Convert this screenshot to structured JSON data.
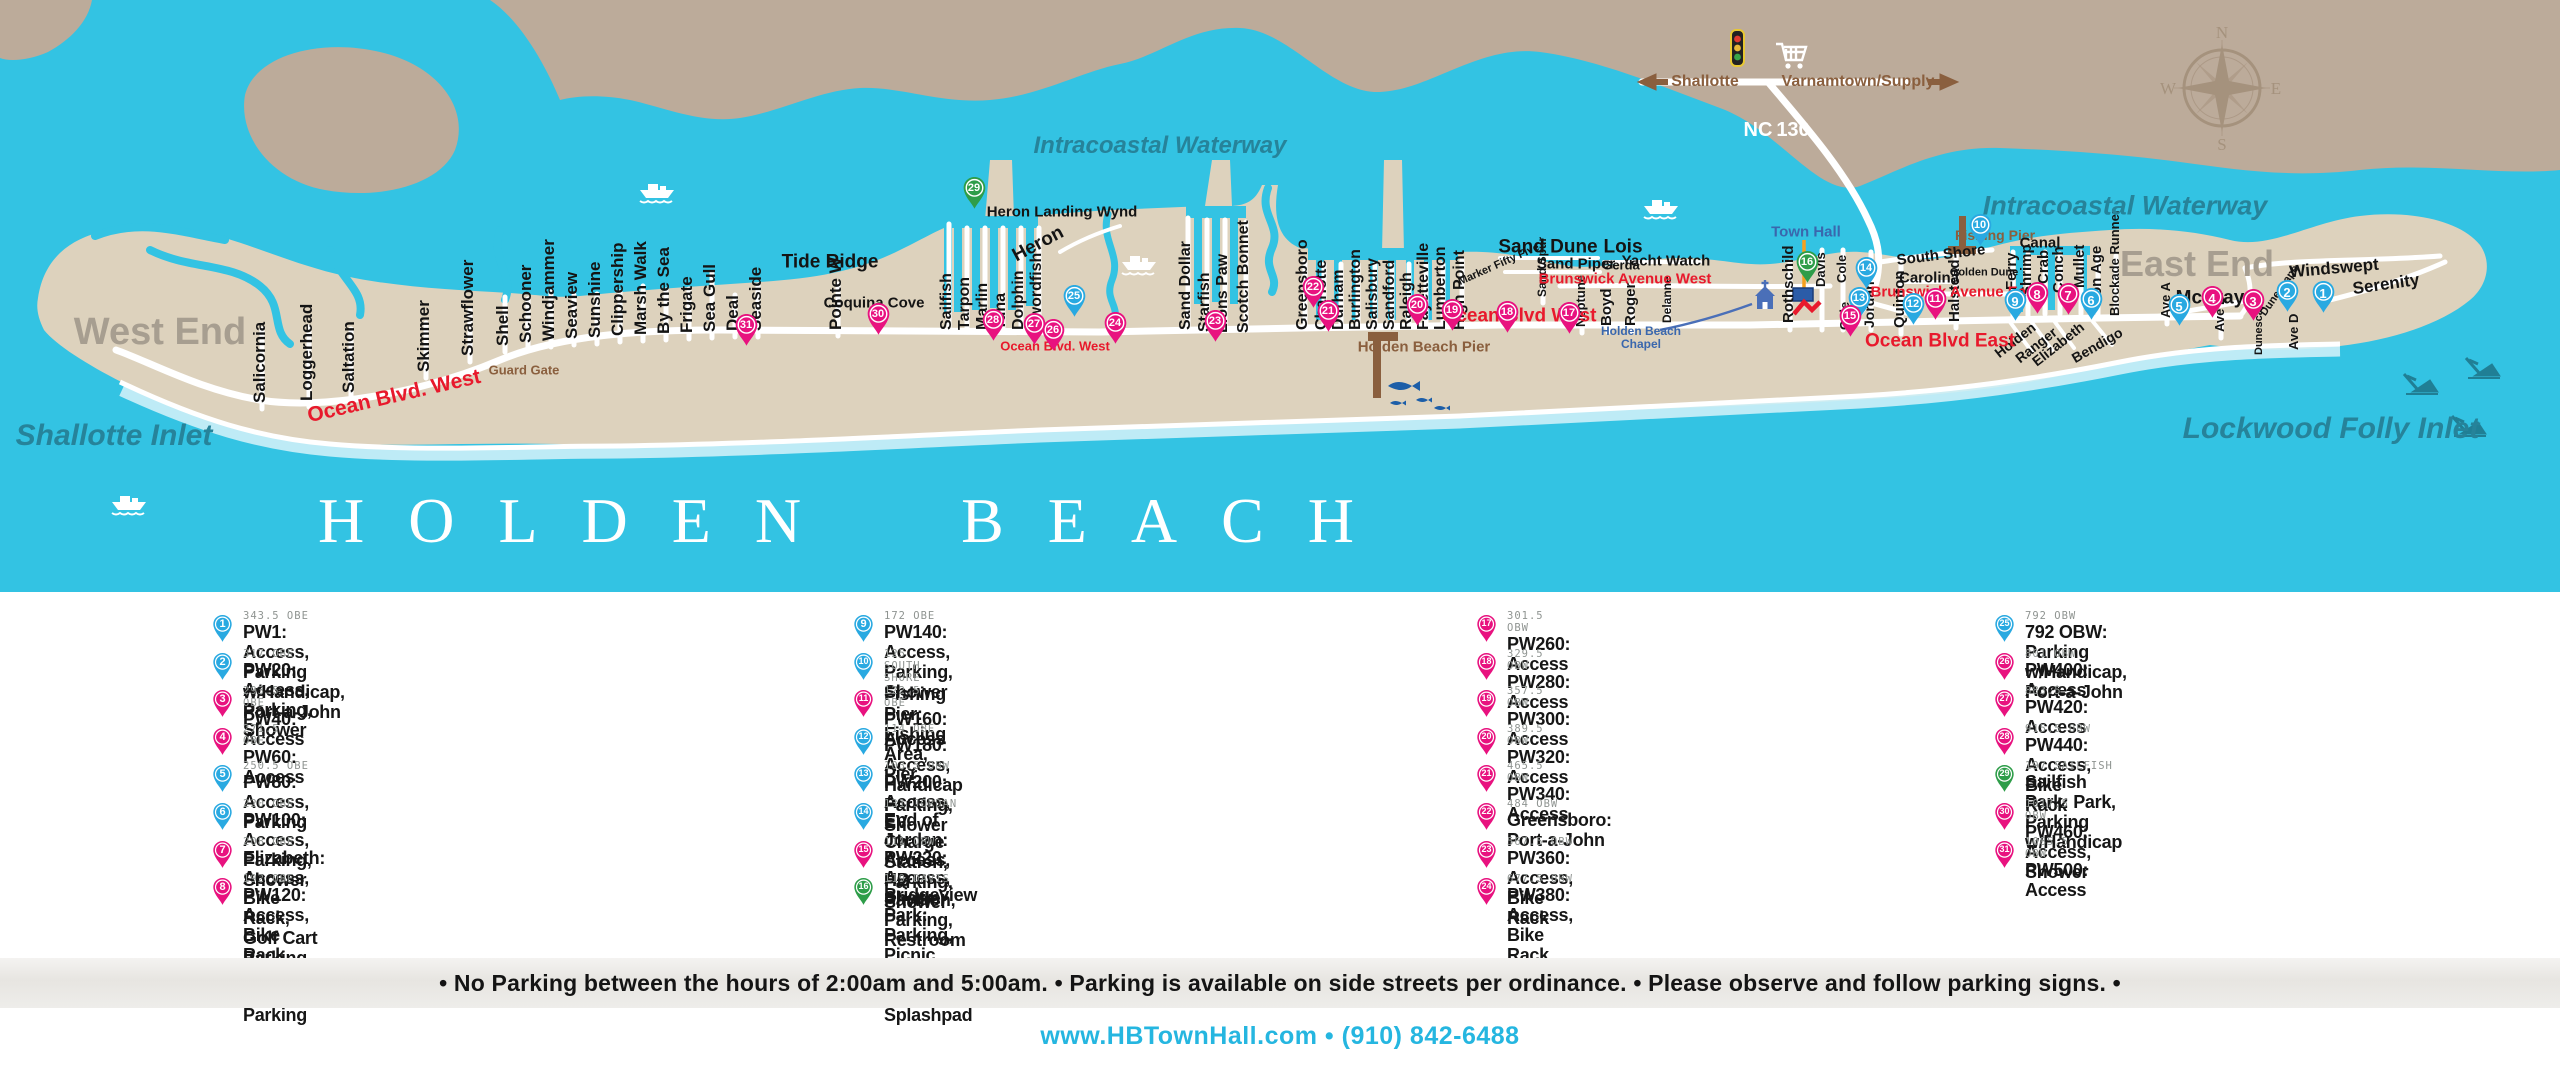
{
  "map": {
    "title_words": [
      "HOLDEN",
      "BEACH"
    ],
    "colors": {
      "water": "#33c3e3",
      "mainland": "#bcab9a",
      "island": "#ddd2bd",
      "pin_pink": "#e8127f",
      "pin_blue": "#29a9e1",
      "pin_green": "#2e9d49",
      "road": "#ffffff",
      "pier_brown": "#8a5f3e",
      "accent_red": "#e8192c",
      "link_cyan": "#25b6e0",
      "orange_pointer": "#f5a01e"
    },
    "compass": {
      "n": "N",
      "e": "E",
      "s": "S",
      "w": "W"
    },
    "vstreets": [
      [
        "Salicornia",
        262,
        403,
        17,
        80
      ],
      [
        "Loggerhead",
        309,
        401,
        17,
        80
      ],
      [
        "Saltation",
        351,
        393,
        17,
        70
      ],
      [
        "Skimmer",
        426,
        372,
        17,
        55
      ],
      [
        "Strawflower",
        470,
        356,
        17,
        52
      ],
      [
        "Shell",
        505,
        346,
        17,
        55
      ],
      [
        "Schooner",
        528,
        343,
        17,
        50
      ],
      [
        "Windjammer",
        551,
        341,
        17,
        55
      ],
      [
        "Seaview",
        574,
        339,
        17,
        50
      ],
      [
        "Sunshine",
        597,
        338,
        17,
        50
      ],
      [
        "Clippership",
        620,
        336,
        17,
        50
      ],
      [
        "Marsh Walk",
        643,
        335,
        17,
        55
      ],
      [
        "By the Sea",
        666,
        334,
        17,
        50
      ],
      [
        "Frigate",
        689,
        333,
        17,
        50
      ],
      [
        "Sea Gull",
        712,
        332,
        17,
        65
      ],
      [
        "Deal",
        735,
        331,
        17,
        42
      ],
      [
        "Seaside",
        758,
        331,
        17,
        52
      ],
      [
        "Pointe W",
        838,
        330,
        17,
        52
      ],
      [
        "Sailfish",
        949,
        330,
        16,
        0
      ],
      [
        "Tarpon",
        967,
        330,
        16,
        0
      ],
      [
        "Marlin",
        985,
        330,
        16,
        0
      ],
      [
        "Tuna",
        1003,
        330,
        16,
        0
      ],
      [
        "Dolphin",
        1021,
        330,
        16,
        0
      ],
      [
        "Swordfish",
        1039,
        330,
        16,
        0
      ],
      [
        "Sand Dollar",
        1188,
        330,
        16,
        0
      ],
      [
        "Starfish",
        1207,
        332,
        16,
        0
      ],
      [
        "Lions Paw",
        1225,
        333,
        16,
        0
      ],
      [
        "Scotch Bonnet",
        1246,
        333,
        16,
        0
      ],
      [
        "Greensboro",
        1305,
        330,
        16,
        0
      ],
      [
        "Charlotte",
        1324,
        330,
        16,
        0
      ],
      [
        "Durham",
        1341,
        330,
        16,
        0
      ],
      [
        "Burlington",
        1358,
        330,
        16,
        0
      ],
      [
        "Salisbury",
        1375,
        330,
        16,
        0
      ],
      [
        "Sandford",
        1392,
        330,
        16,
        0
      ],
      [
        "Raleigh",
        1409,
        330,
        16,
        0
      ],
      [
        "Fayetteville",
        1426,
        330,
        16,
        0
      ],
      [
        "Lumberton",
        1443,
        330,
        16,
        0
      ],
      [
        "High Point",
        1462,
        330,
        16,
        0
      ],
      [
        "Sand Spur",
        1543,
        297,
        12,
        40
      ],
      [
        "Neptune",
        1582,
        327,
        13,
        38
      ],
      [
        "Boyd",
        1608,
        326,
        15,
        38
      ],
      [
        "Roger",
        1632,
        326,
        15,
        38
      ],
      [
        "Delanne",
        1668,
        323,
        12,
        32
      ],
      [
        "Rothschild",
        1790,
        323,
        15,
        60
      ],
      [
        "Davis",
        1822,
        287,
        13,
        0
      ],
      [
        "Cole",
        1843,
        283,
        13,
        0
      ],
      [
        "Cole",
        1846,
        330,
        13,
        0
      ],
      [
        "Jordan",
        1871,
        328,
        14,
        0
      ],
      [
        "Quinton",
        1901,
        328,
        15,
        70
      ],
      [
        "Halstead",
        1956,
        322,
        15,
        78
      ],
      [
        "Ferry",
        2013,
        290,
        15,
        0
      ],
      [
        "Shrimp",
        2028,
        296,
        15,
        0
      ],
      [
        "Crab",
        2045,
        284,
        15,
        0
      ],
      [
        "Conch",
        2060,
        293,
        15,
        0
      ],
      [
        "Mullet",
        2081,
        288,
        15,
        0
      ],
      [
        "Iron Age",
        2098,
        306,
        15,
        0
      ],
      [
        "Blockade Runner",
        2116,
        316,
        13,
        0
      ],
      [
        "Ave A",
        2167,
        318,
        13,
        20
      ],
      [
        "Ave B",
        2221,
        332,
        13,
        18
      ],
      [
        "Dunescape",
        2261,
        355,
        11,
        0
      ],
      [
        "Ave D",
        2295,
        350,
        13,
        0
      ]
    ],
    "labels": [
      [
        "Intracoastal Waterway",
        1160,
        146,
        24,
        "teal",
        0
      ],
      [
        "Intracoastal Waterway",
        2125,
        206,
        27,
        "teal",
        0
      ],
      [
        "West End",
        160,
        332,
        38,
        "gray",
        0
      ],
      [
        "East End",
        2197,
        264,
        36,
        "gray",
        0
      ],
      [
        "Shallotte Inlet",
        114,
        436,
        30,
        "teal",
        0
      ],
      [
        "Lockwood Folly Inlet",
        2331,
        429,
        30,
        "teal",
        0
      ],
      [
        "Shallotte",
        1705,
        82,
        16,
        "brown",
        0
      ],
      [
        "Varnamtown/Supply",
        1858,
        82,
        16,
        "brown",
        0
      ],
      [
        "NC",
        1758,
        130,
        20,
        "white",
        0
      ],
      [
        "130",
        1793,
        130,
        20,
        "white",
        0
      ],
      [
        "Town Hall",
        1806,
        232,
        15,
        "blue",
        0
      ],
      [
        "Holden Beach",
        1641,
        331,
        12,
        "blue",
        0
      ],
      [
        "Chapel",
        1641,
        344,
        12,
        "blue",
        0
      ],
      [
        "Guard Gate",
        524,
        370,
        13,
        "brown",
        0
      ],
      [
        "Holden Beach Pier",
        1424,
        347,
        15,
        "brown",
        0
      ],
      [
        "Fishing Pier",
        1995,
        235,
        14,
        "brown",
        0
      ],
      [
        "Tide Ridge",
        830,
        262,
        19,
        "black",
        0
      ],
      [
        "Coquina Cove",
        874,
        303,
        15,
        "black",
        0
      ],
      [
        "Heron Landing Wynd",
        1062,
        212,
        15,
        "black",
        0
      ],
      [
        "Heron",
        1038,
        244,
        19,
        "black",
        -28
      ],
      [
        "Sand Dune",
        1548,
        247,
        19,
        "black",
        0
      ],
      [
        "Sand Piper",
        1576,
        264,
        15,
        "black",
        0
      ],
      [
        "Lois",
        1623,
        247,
        19,
        "black",
        0
      ],
      [
        "Gerda",
        1621,
        265,
        13,
        "black",
        0
      ],
      [
        "Yacht Watch",
        1666,
        261,
        15,
        "black",
        0
      ],
      [
        "Marker Fifty Five",
        1499,
        265,
        11,
        "black",
        -24
      ],
      [
        "South Shore",
        1941,
        255,
        15,
        "black",
        -7
      ],
      [
        "Carolina",
        1929,
        278,
        15,
        "black",
        0
      ],
      [
        "Golden Dune",
        1984,
        273,
        11,
        "black",
        0
      ],
      [
        "Canal",
        2040,
        243,
        15,
        "black",
        0
      ],
      [
        "McCray",
        2210,
        298,
        19,
        "black",
        0
      ],
      [
        "Windswept",
        2334,
        268,
        17,
        "black",
        -5
      ],
      [
        "Serenity",
        2386,
        284,
        17,
        "black",
        -8
      ],
      [
        "Holden",
        2015,
        340,
        14,
        "black",
        -38
      ],
      [
        "Ranger",
        2036,
        345,
        14,
        "black",
        -38
      ],
      [
        "Elizabeth",
        2058,
        344,
        14,
        "black",
        -38
      ],
      [
        "Bendigo",
        2097,
        345,
        14,
        "black",
        -30
      ],
      [
        "Dunescape",
        2280,
        291,
        11,
        "black",
        -55
      ],
      [
        "Ocean Blvd. West",
        394,
        396,
        21,
        "red",
        -13
      ],
      [
        "Ocean Blvd. West",
        1055,
        346,
        13,
        "red",
        0
      ],
      [
        "Ocean Blvd West",
        1519,
        316,
        19,
        "red",
        0
      ],
      [
        "Ocean Blvd East",
        1940,
        341,
        19,
        "red",
        0
      ],
      [
        "Brunswick Avenue West",
        1625,
        279,
        15,
        "red",
        0
      ],
      [
        "Brunswick   Avenue East",
        1955,
        292,
        15,
        "red",
        0
      ]
    ],
    "markers": [
      [
        1,
        2323,
        314,
        "blue"
      ],
      [
        2,
        2287,
        313,
        "blue"
      ],
      [
        3,
        2253,
        322,
        "pink"
      ],
      [
        4,
        2212,
        319,
        "pink"
      ],
      [
        5,
        2179,
        327,
        "blue"
      ],
      [
        6,
        2091,
        321,
        "blue"
      ],
      [
        7,
        2068,
        316,
        "pink"
      ],
      [
        8,
        2037,
        315,
        "pink"
      ],
      [
        9,
        2015,
        322,
        "blue"
      ],
      [
        10,
        1980,
        247,
        "blue"
      ],
      [
        11,
        1935,
        321,
        "pink"
      ],
      [
        12,
        1913,
        326,
        "blue"
      ],
      [
        13,
        1859,
        320,
        "blue"
      ],
      [
        14,
        1866,
        290,
        "blue"
      ],
      [
        15,
        1850,
        338,
        "pink"
      ],
      [
        16,
        1807,
        284,
        "green"
      ],
      [
        17,
        1569,
        335,
        "pink"
      ],
      [
        18,
        1507,
        334,
        "pink"
      ],
      [
        19,
        1452,
        332,
        "pink"
      ],
      [
        20,
        1417,
        327,
        "pink"
      ],
      [
        21,
        1328,
        333,
        "pink"
      ],
      [
        22,
        1313,
        309,
        "pink"
      ],
      [
        23,
        1215,
        343,
        "pink"
      ],
      [
        24,
        1115,
        345,
        "pink"
      ],
      [
        25,
        1074,
        318,
        "blue"
      ],
      [
        26,
        1053,
        352,
        "pink"
      ],
      [
        27,
        1034,
        346,
        "pink"
      ],
      [
        28,
        993,
        342,
        "pink"
      ],
      [
        29,
        974,
        210,
        "green"
      ],
      [
        30,
        878,
        336,
        "pink"
      ],
      [
        31,
        746,
        347,
        "pink"
      ]
    ],
    "direction_signs": {
      "west": "Shallotte",
      "east": "Varnamtown/Supply"
    }
  },
  "legend": {
    "columns": [
      [
        {
          "n": 1,
          "c": "blue",
          "addr": "343.5 OBE",
          "name": "PW1: Access, Parking w/Handicap, Port-a-John"
        },
        {
          "n": 2,
          "c": "blue",
          "addr": "317 OBE",
          "name": "PW20: Access, Parking, Shower"
        },
        {
          "n": 3,
          "c": "pink",
          "addr": "293.5 OBE",
          "name": "PW40: Access"
        },
        {
          "n": 4,
          "c": "pink",
          "addr": "271.5 OBE",
          "name": "PW60: Access"
        },
        {
          "n": 5,
          "c": "blue",
          "addr": "250.5 OBE",
          "name": "PW80: Access, Parking"
        },
        {
          "n": 6,
          "c": "blue",
          "addr": "220 OBE",
          "name": "PW100: Access, Parking, Shower"
        },
        {
          "n": 7,
          "c": "pink",
          "addr": "208 OBE",
          "name": "Elizabeth: Access, Bike Rack, Golf Cart Parking"
        },
        {
          "n": 8,
          "c": "pink",
          "addr": "192 OBE",
          "name": "PW120: Access, Bike Rack, Golf Cart Parking"
        }
      ],
      [
        {
          "n": 9,
          "c": "blue",
          "addr": "172 OBE",
          "name": "PW140: Access, Parking, Shower"
        },
        {
          "n": 10,
          "c": "blue",
          "addr": "125 SOUTH SHORE",
          "name": "Fishing Pier: Fishing Area, Pier"
        },
        {
          "n": 11,
          "c": "pink",
          "addr": "122.5 OBE",
          "name": "PW160: Access"
        },
        {
          "n": 12,
          "c": "blue",
          "addr": "114 OBE",
          "name": "PW180: Access, Handicap Parking, Shower"
        },
        {
          "n": 13,
          "c": "blue",
          "addr": "103.5 OBW",
          "name": "PW200: Access, EV Charge Station, Parking, Shower"
        },
        {
          "n": 14,
          "c": "blue",
          "addr": "131 JORDAN",
          "name": "End of Jordan: Access, HB Pavilion, Parking, Restroom"
        },
        {
          "n": 15,
          "c": "pink",
          "addr": "111 OBW",
          "name": "PW220: Access, Shower"
        },
        {
          "n": 16,
          "c": "green",
          "addr": "119 DAVIS",
          "name": "Bridgeview Park: Parking, Picnic Shelter, Playground, Splashpad"
        }
      ],
      [
        {
          "n": 17,
          "c": "pink",
          "addr": "301.5 OBW",
          "name": "PW260: Access"
        },
        {
          "n": 18,
          "c": "pink",
          "addr": "329.5 OBW",
          "name": "PW280: Access"
        },
        {
          "n": 19,
          "c": "pink",
          "addr": "357.5 OBW",
          "name": "PW300: Access"
        },
        {
          "n": 20,
          "c": "pink",
          "addr": "389.5 OBW",
          "name": "PW320: Access"
        },
        {
          "n": 21,
          "c": "pink",
          "addr": "465.5 OBW",
          "name": "PW340: Access"
        },
        {
          "n": 22,
          "c": "pink",
          "addr": "484 OBW",
          "name": "Greensboro: Port-a-John"
        },
        {
          "n": 23,
          "c": "pink",
          "addr": "567.5 OBW",
          "name": "PW360: Access, Bike Rack"
        },
        {
          "n": 24,
          "c": "pink",
          "addr": "677.5 OBW",
          "name": "PW380: Access, Bike Rack"
        }
      ],
      [
        {
          "n": 25,
          "c": "blue",
          "addr": "792 OBW",
          "name": "792 OBW: Parking w/Handicap, Port-a-John"
        },
        {
          "n": 26,
          "c": "pink",
          "addr": "801 OBW",
          "name": "PW400: Access"
        },
        {
          "n": 27,
          "c": "pink",
          "addr": "883.5",
          "name": "PW420: Access"
        },
        {
          "n": 28,
          "c": "pink",
          "addr": "915.5 OBW",
          "name": "PW440: Access, Bike Rack"
        },
        {
          "n": 29,
          "c": "green",
          "addr": "197 SAILFISH",
          "name": "Sailfish Park: Park, Parking w/Handicap"
        },
        {
          "n": 30,
          "c": "pink",
          "addr": "1017.5 OBW",
          "name": "PW460: Access, Shower"
        },
        {
          "n": 31,
          "c": "pink",
          "addr": "1085.5 OBW",
          "name": "PW500: Access"
        }
      ]
    ]
  },
  "notice": "•  No Parking between the hours of 2:00am and 5:00am.  •  Parking is available on side streets per ordinance.  •  Please observe and follow parking signs.  •",
  "footer": "www.HBTownHall.com  •  (910) 842-6488"
}
